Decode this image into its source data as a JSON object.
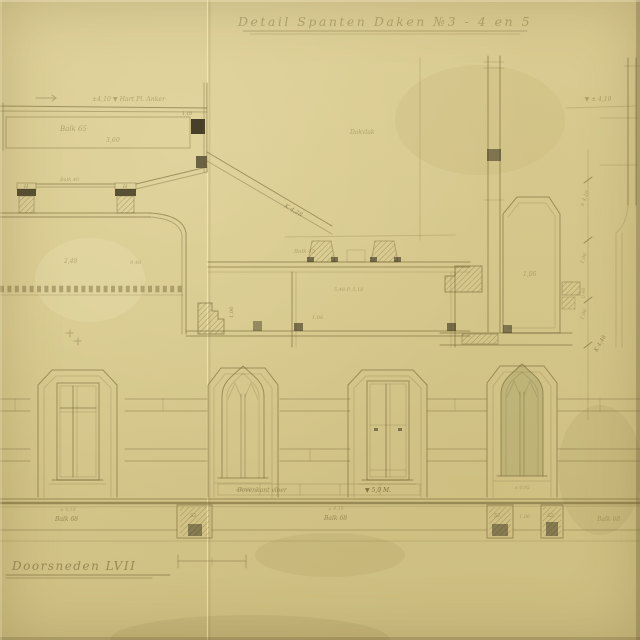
{
  "colors": {
    "paper": "#d6c88c",
    "ink": "#6b5c2e",
    "dark_ink": "#2c2514"
  },
  "title": {
    "text": "Detail Spanten Daken  №3 - 4 en 5"
  },
  "section_label": {
    "text": "Doorsneden LVII"
  },
  "annotations": {
    "top_left_level": "±4,10  ▼ Hart Pl. Anker",
    "balk_65": "Balk 65",
    "dim_3_60": "3,60",
    "dim_1_10": "1,10",
    "post_h_left": "H",
    "post_h_right": "H",
    "balk_40": "Balk 40",
    "dim_2_48": "2,48",
    "dim_8_48": "8,48",
    "k_4_28": "K 4,28",
    "dakvlak": "Dakvlak",
    "balk_45": "Balk 45",
    "note_5_48": "5,48 P. 5,18",
    "dim_1_06_a": "1,06",
    "dim_1_06_b": "1,06",
    "dim_1_06_c": "1,06",
    "dim_1_06_d": "1,06",
    "dim_0_48": "0,48",
    "top_right_level": "▼ ± 4,10",
    "dim_chain_a": "± 4,10",
    "dim_chain_b": "1,06",
    "k_4_48": "K 4,48",
    "floor_label": "Bovenkant vloer",
    "floor_level": "▼ 5,0 M.",
    "sill_left": "± 0,95",
    "sill_right": "± 0,95",
    "tiny_4_10_left": "± 4,10",
    "balk_68_left": "Balk 68",
    "tiny_4_10_mid": "± 4,10",
    "balk_68_mid": "Balk 68",
    "balk_68_right": "Balk 68",
    "pier_52_a": "52",
    "pier_52_b": "52",
    "pier_52_c": "52",
    "dim_1_06_pier": "1,06"
  }
}
